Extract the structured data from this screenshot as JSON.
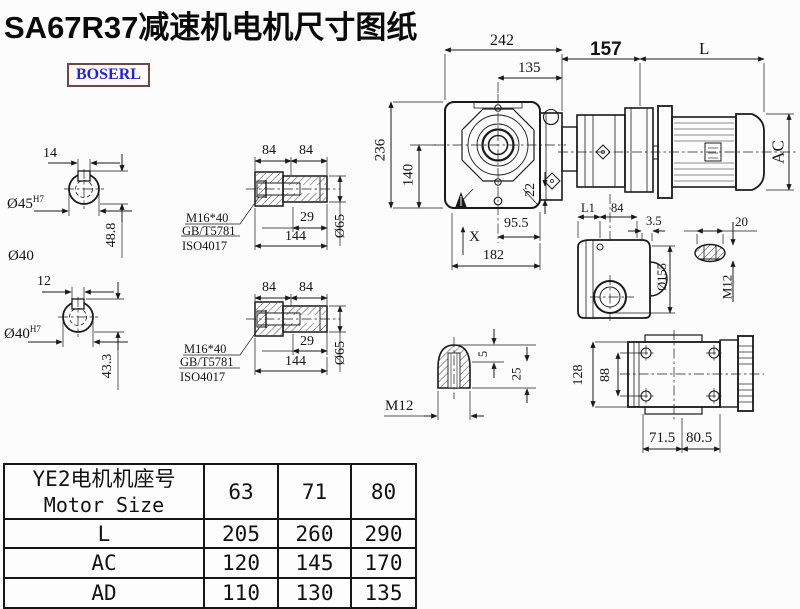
{
  "title": "SA67R37减速机电机尺寸图纸",
  "brand": "BOSERL",
  "d": {
    "v1": {
      "w": "14",
      "bore": "Ø45",
      "tol": "H7",
      "h": "48.8",
      "shaft": "Ø40"
    },
    "v2": {
      "w": "12",
      "bore": "Ø40",
      "tol": "H7",
      "h": "43.3"
    },
    "h1": {
      "a": "84",
      "b": "84",
      "bolt": "M16*40",
      "std1": "GB/T5781",
      "std2": "ISO4017",
      "depth": "29",
      "len": "144",
      "dia": "Ø65"
    },
    "h2": {
      "a": "84",
      "b": "84",
      "bolt": "M16*40",
      "std1": "GB/T5781",
      "std2": "ISO4017",
      "depth": "29",
      "len": "144",
      "dia": "Ø65"
    },
    "front": {
      "w": "242",
      "wi": "135",
      "h": "236",
      "hi": "140",
      "step": "22",
      "f1": "95.5",
      "f2": "182",
      "x": "X"
    },
    "motor": {
      "adapter": "157",
      "len": "L",
      "dia": "AC"
    },
    "side": {
      "l1": "L1",
      "len": "84",
      "off": "3.5",
      "key": "20",
      "dia": "Ø155",
      "thr": "M12"
    },
    "tip": {
      "a": "5",
      "b": "25",
      "thr": "M12"
    },
    "bottom": {
      "h": "128",
      "span": "88",
      "a": "71.5",
      "b": "80.5"
    }
  },
  "table": {
    "header_cn": "YE2电机机座号",
    "header_en": "Motor Size",
    "sizes": [
      "63",
      "71",
      "80"
    ],
    "rows": [
      {
        "label": "L",
        "values": [
          "205",
          "260",
          "290"
        ]
      },
      {
        "label": "AC",
        "values": [
          "120",
          "145",
          "170"
        ]
      },
      {
        "label": "AD",
        "values": [
          "110",
          "130",
          "135"
        ]
      }
    ]
  },
  "colors": {
    "line": "#1a1a1a",
    "brand_text": "#2525c8",
    "brand_border": "#6e4747",
    "background": "#fcfcfc"
  }
}
